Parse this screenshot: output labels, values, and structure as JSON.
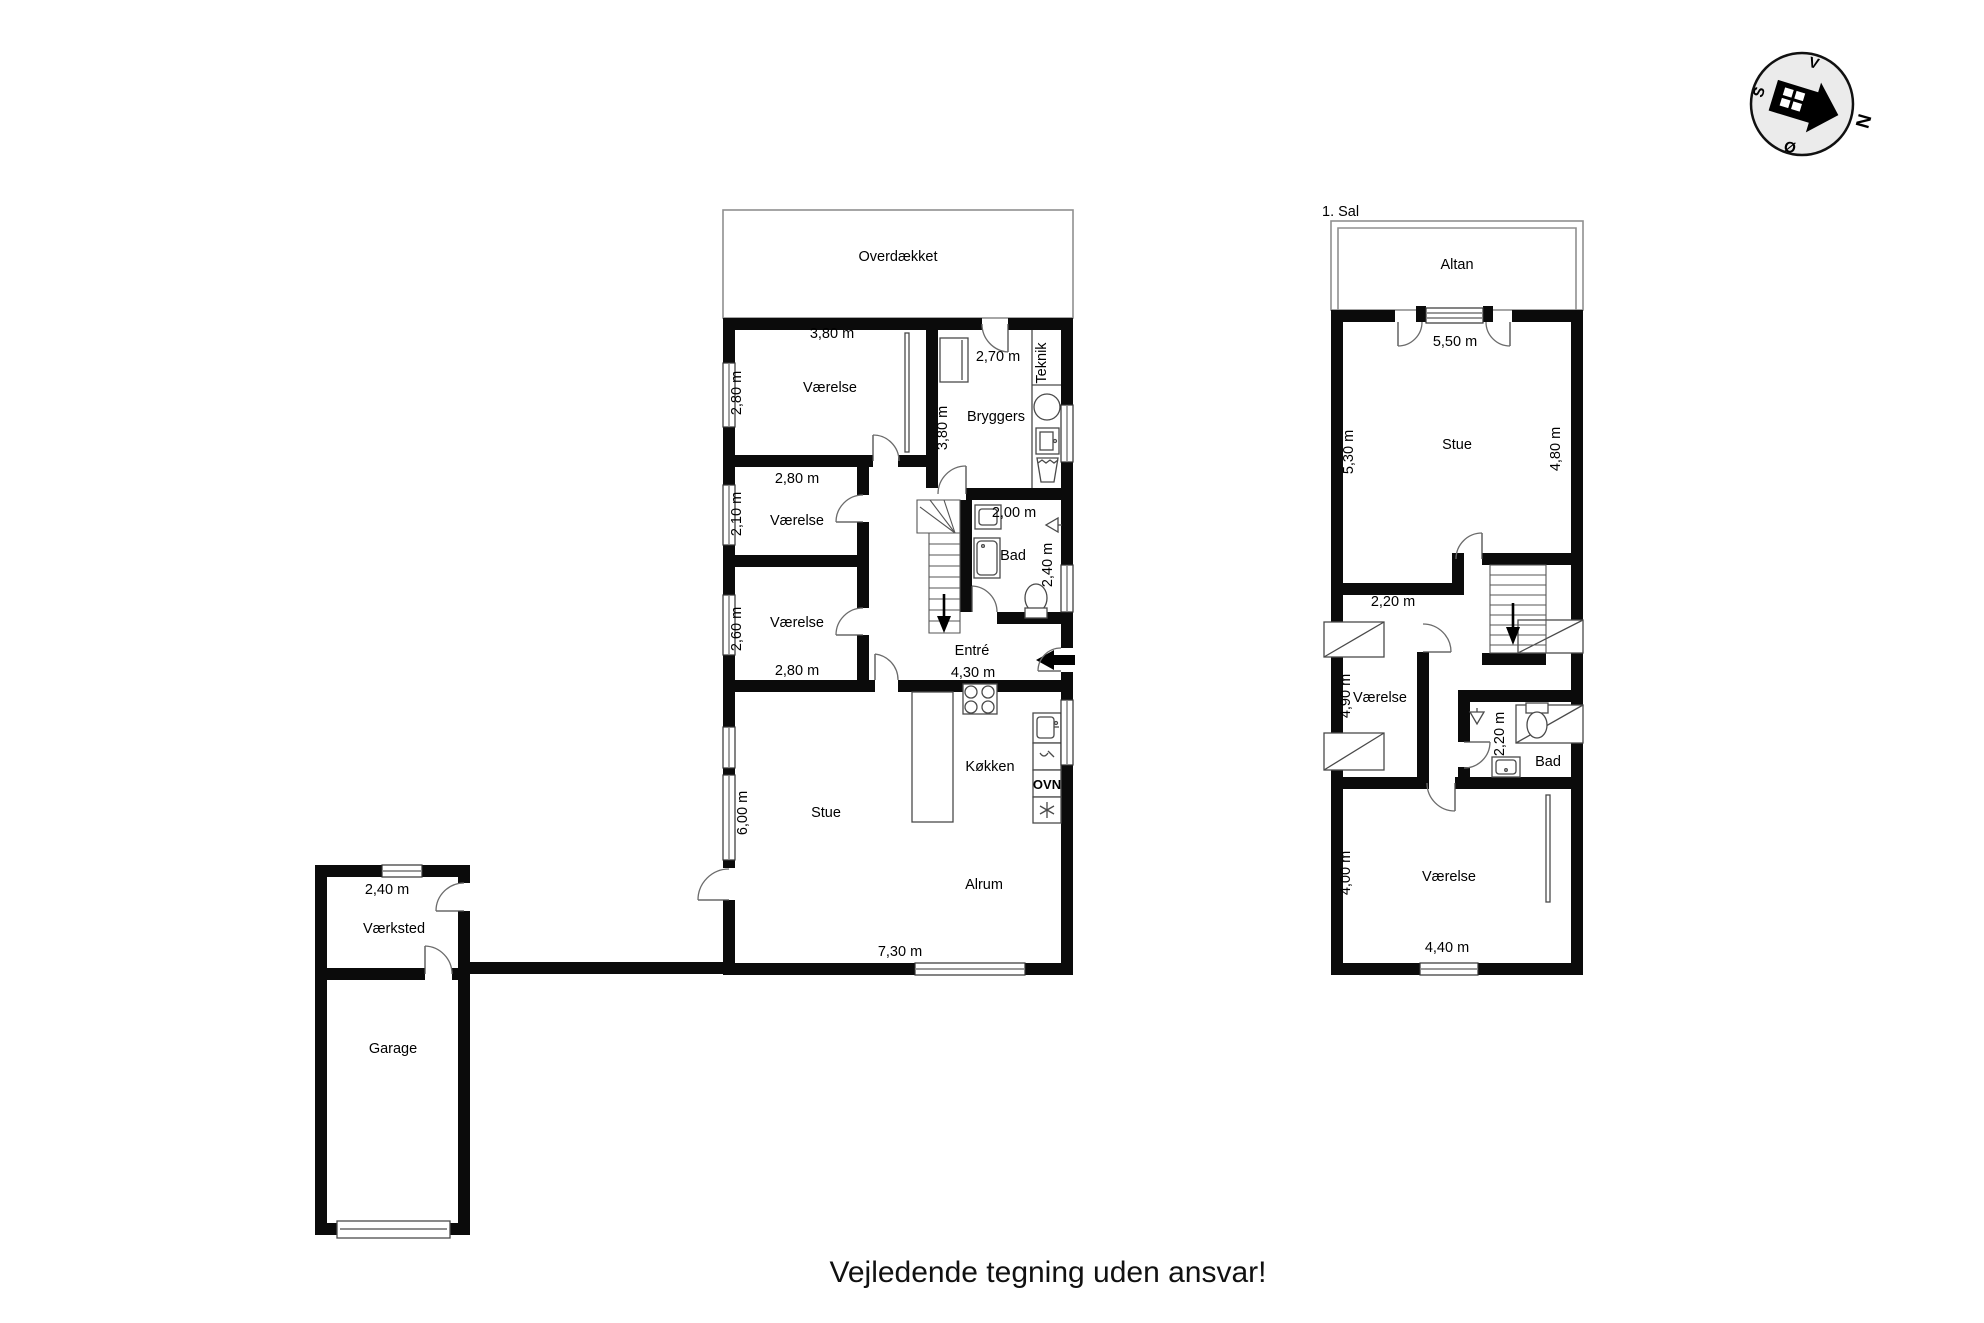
{
  "disclaimer": "Vejledende tegning uden ansvar!",
  "compass": {
    "north": "N",
    "south": "S",
    "east": "Ø",
    "west": "V"
  },
  "ground_floor": {
    "outdoor_label": "Overdækket",
    "vaerelse1": {
      "name": "Værelse",
      "width": "3,80 m",
      "depth": "2,80 m"
    },
    "bryggers": {
      "name": "Bryggers",
      "width": "2,70 m",
      "depth": "3,80 m"
    },
    "teknik_label": "Teknik",
    "vaerelse2": {
      "name": "Værelse",
      "width": "2,80 m",
      "depth": "2,10 m"
    },
    "vaerelse3": {
      "name": "Værelse",
      "width": "2,80 m",
      "depth": "2,60 m"
    },
    "bad": {
      "name": "Bad",
      "width": "2,00 m",
      "depth": "2,40 m"
    },
    "entre": {
      "name": "Entré",
      "width": "4,30 m"
    },
    "kokken": {
      "name": "Køkken",
      "oven_label": "OVN"
    },
    "stue": {
      "name": "Stue",
      "depth": "6,00 m"
    },
    "alrum": {
      "name": "Alrum",
      "width": "7,30 m"
    }
  },
  "outbuilding": {
    "vaerksted": {
      "name": "Værksted",
      "width": "2,40 m"
    },
    "garage": {
      "name": "Garage"
    }
  },
  "first_floor": {
    "floor_label": "1. Sal",
    "outdoor_label": "Altan",
    "stue": {
      "name": "Stue",
      "width": "5,50 m",
      "left_depth": "5,30 m",
      "right_depth": "4,80 m"
    },
    "vaerelse_mid": {
      "name": "Værelse",
      "width": "2,20 m",
      "depth": "4,90 m"
    },
    "bad": {
      "name": "Bad",
      "depth": "2,20 m"
    },
    "vaerelse_syd": {
      "name": "Værelse",
      "width": "4,40 m",
      "depth": "4,00 m"
    }
  }
}
